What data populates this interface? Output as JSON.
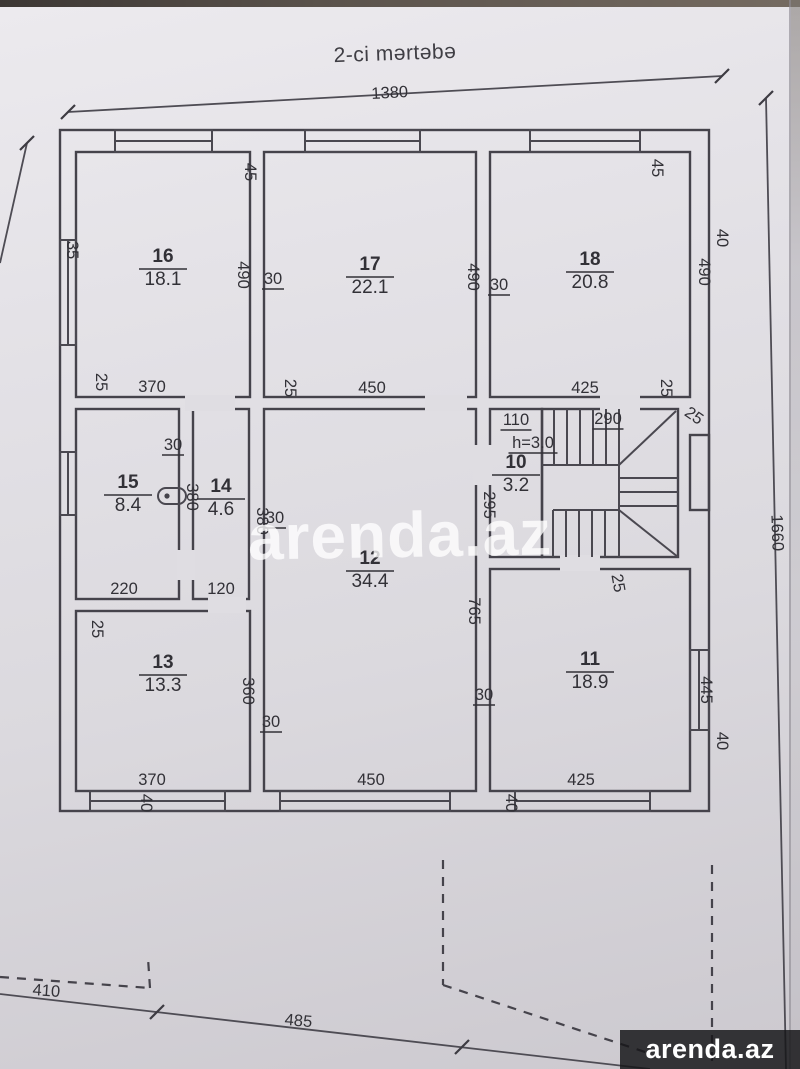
{
  "page": {
    "title": "2-ci mərtəbə",
    "watermark": "arenda.az",
    "brand_logo": "arenda.az"
  },
  "plan": {
    "ceiling_height_label": "h=3.0",
    "overall_width_cm": "1380",
    "overall_depth_cm": "1660",
    "rooms": [
      {
        "number": "16",
        "area": "18.1",
        "x": 163,
        "y": 262
      },
      {
        "number": "17",
        "area": "22.1",
        "x": 370,
        "y": 270
      },
      {
        "number": "18",
        "area": "20.8",
        "x": 590,
        "y": 265
      },
      {
        "number": "15",
        "area": "8.4",
        "x": 128,
        "y": 488
      },
      {
        "number": "14",
        "area": "4.6",
        "x": 221,
        "y": 492
      },
      {
        "number": "10",
        "area": "3.2",
        "x": 516,
        "y": 468
      },
      {
        "number": "12",
        "area": "34.4",
        "x": 370,
        "y": 564
      },
      {
        "number": "13",
        "area": "13.3",
        "x": 163,
        "y": 668
      },
      {
        "number": "11",
        "area": "18.9",
        "x": 590,
        "y": 665
      }
    ],
    "dimension_labels": [
      {
        "t": "1380",
        "x": 390,
        "y": 98,
        "r": -3
      },
      {
        "t": "45",
        "x": 245,
        "y": 172,
        "r": 90
      },
      {
        "t": "45",
        "x": 652,
        "y": 168,
        "r": 90
      },
      {
        "t": "35",
        "x": 67,
        "y": 250,
        "r": 90
      },
      {
        "t": "490",
        "x": 238,
        "y": 275,
        "r": 90
      },
      {
        "t": "30",
        "x": 273,
        "y": 284,
        "r": 0,
        "u": true
      },
      {
        "t": "490",
        "x": 468,
        "y": 277,
        "r": 90
      },
      {
        "t": "30",
        "x": 499,
        "y": 290,
        "r": 0,
        "u": true
      },
      {
        "t": "490",
        "x": 699,
        "y": 272,
        "r": 90
      },
      {
        "t": "40",
        "x": 717,
        "y": 238,
        "r": 90
      },
      {
        "t": "25",
        "x": 96,
        "y": 382,
        "r": 90
      },
      {
        "t": "370",
        "x": 152,
        "y": 392,
        "r": 0
      },
      {
        "t": "25",
        "x": 285,
        "y": 388,
        "r": 90
      },
      {
        "t": "450",
        "x": 372,
        "y": 393,
        "r": 0
      },
      {
        "t": "425",
        "x": 585,
        "y": 393,
        "r": 0
      },
      {
        "t": "25",
        "x": 661,
        "y": 388,
        "r": 90
      },
      {
        "t": "110",
        "x": 516,
        "y": 425,
        "r": 0,
        "u": true
      },
      {
        "t": "290",
        "x": 608,
        "y": 424,
        "r": 0,
        "u": true
      },
      {
        "t": "25",
        "x": 691,
        "y": 420,
        "r": 35
      },
      {
        "t": "h=3.0",
        "x": 533,
        "y": 448,
        "r": 0,
        "u": true
      },
      {
        "t": "295",
        "x": 484,
        "y": 505,
        "r": 90
      },
      {
        "t": "30",
        "x": 173,
        "y": 450,
        "r": 0,
        "u": true
      },
      {
        "t": "380",
        "x": 187,
        "y": 497,
        "r": 90
      },
      {
        "t": "380",
        "x": 257,
        "y": 521,
        "r": 90
      },
      {
        "t": "30",
        "x": 275,
        "y": 523,
        "r": 0,
        "u": true
      },
      {
        "t": "220",
        "x": 124,
        "y": 594,
        "r": 0
      },
      {
        "t": "120",
        "x": 221,
        "y": 594,
        "r": 0
      },
      {
        "t": "25",
        "x": 92,
        "y": 629,
        "r": 90
      },
      {
        "t": "360",
        "x": 243,
        "y": 691,
        "r": 90
      },
      {
        "t": "30",
        "x": 271,
        "y": 727,
        "r": 0,
        "u": true
      },
      {
        "t": "370",
        "x": 152,
        "y": 785,
        "r": 0
      },
      {
        "t": "40",
        "x": 141,
        "y": 803,
        "r": 90
      },
      {
        "t": "450",
        "x": 371,
        "y": 785,
        "r": 0
      },
      {
        "t": "765",
        "x": 469,
        "y": 611,
        "r": 90
      },
      {
        "t": "30",
        "x": 484,
        "y": 700,
        "r": 0,
        "u": true
      },
      {
        "t": "25",
        "x": 613,
        "y": 584,
        "r": 80
      },
      {
        "t": "445",
        "x": 701,
        "y": 690,
        "r": 90
      },
      {
        "t": "40",
        "x": 717,
        "y": 741,
        "r": 90
      },
      {
        "t": "425",
        "x": 581,
        "y": 785,
        "r": 0
      },
      {
        "t": "40",
        "x": 506,
        "y": 803,
        "r": 90
      },
      {
        "t": "410",
        "x": 46,
        "y": 996,
        "r": 4
      },
      {
        "t": "485",
        "x": 298,
        "y": 1026,
        "r": 5
      },
      {
        "t": "1660",
        "x": 772,
        "y": 533,
        "r": 88
      }
    ]
  }
}
